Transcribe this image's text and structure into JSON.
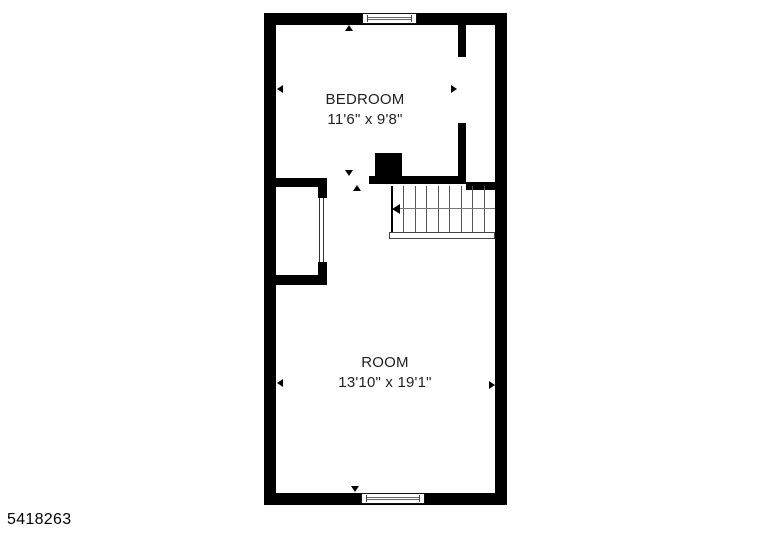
{
  "plan_id": "5418263",
  "rooms": {
    "bedroom": {
      "name": "BEDROOM",
      "dimensions": "11'6\" x 9'8\""
    },
    "room": {
      "name": "ROOM",
      "dimensions": "13'10\" x 19'1\""
    }
  },
  "stairs": {
    "tread_count": 9,
    "run_direction": "left"
  },
  "features": {
    "windows": [
      "top-wall-window",
      "bottom-wall-window"
    ],
    "closet": "sliding-door-closet",
    "chimney": "chimney-block"
  },
  "colors": {
    "wall": "#000000",
    "background": "#ffffff",
    "text": "#212121",
    "stair_line": "#555555"
  }
}
